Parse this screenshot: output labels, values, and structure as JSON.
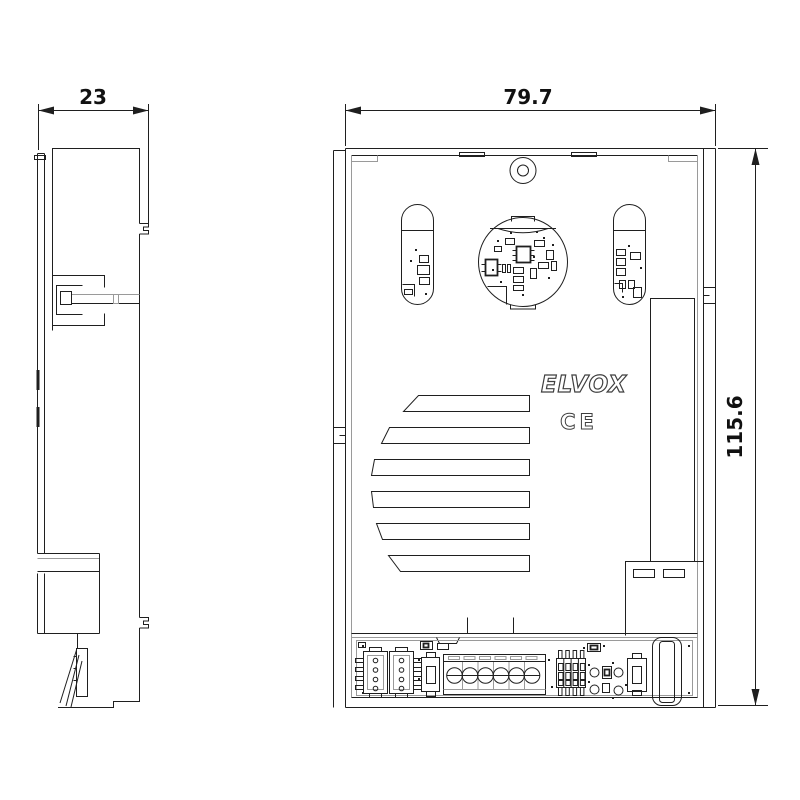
{
  "page": {
    "background": "#ffffff"
  },
  "drawing": {
    "stroke": "#1f1f1f",
    "stroke_light": "#9a9a9a",
    "brand_logo": "ELVOX",
    "ce_mark": "CE",
    "dimensions": {
      "side_width": "23",
      "front_width": "79.7",
      "front_height": "115.6"
    }
  }
}
